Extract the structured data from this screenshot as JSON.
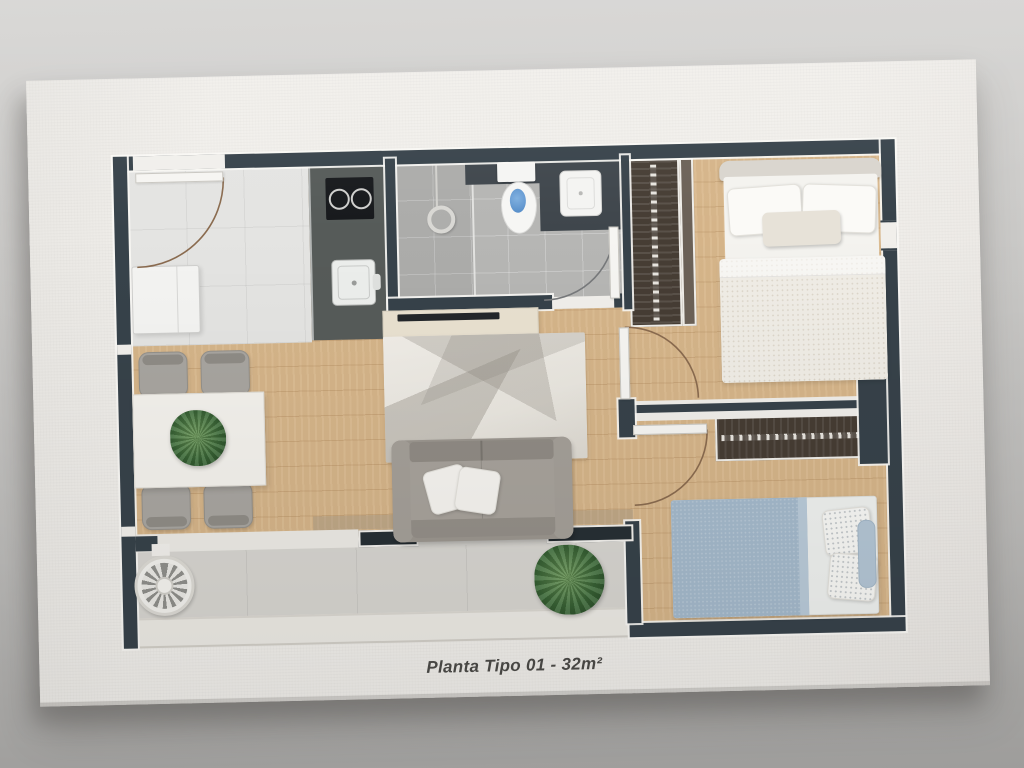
{
  "caption": {
    "text": "Planta Tipo 01 - 32m²"
  },
  "palette": {
    "bgTop": "#d5d4d2",
    "bgBottom": "#aaa9a7",
    "board": "#f1efeb",
    "wall": "#37424a",
    "wood": "#d9b88c",
    "tileEntry": "#e4e4e2",
    "tileBath": "#b6b6b4",
    "tileBalcony": "#d7d5d0",
    "counter": "#565b59",
    "cooktop": "#17191c",
    "closet": "#463d34",
    "rug": "#e9e6df",
    "sofa": "#9b968f",
    "chair": "#a8a5a0",
    "plant": "#3f6e3b",
    "plantLight": "#6f9c5c",
    "water": "#4f87c5",
    "blueBlanket": "#a4b9cb",
    "captionColor": "#4c4b48"
  }
}
